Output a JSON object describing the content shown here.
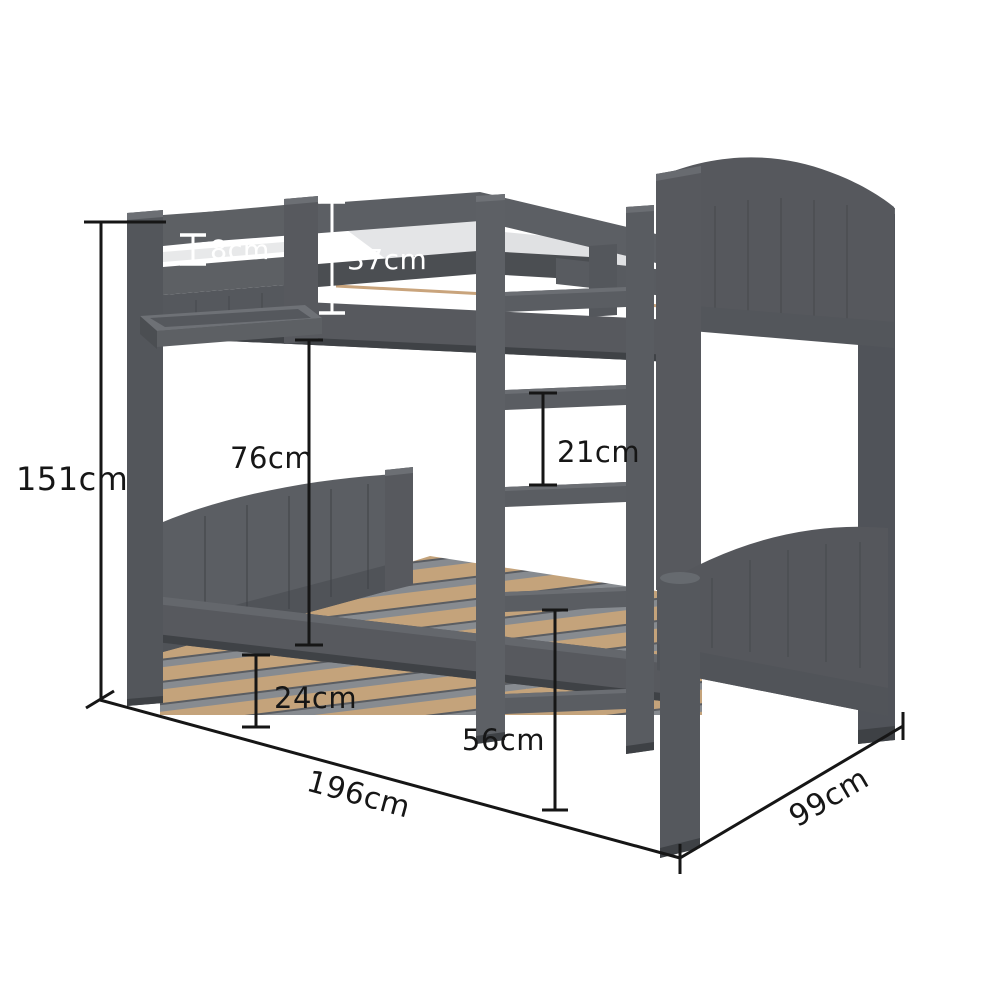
{
  "figure": {
    "type": "product-dimension-diagram",
    "subject": "grey wooden bunk bed with front ladder and slatted base",
    "background": "#ffffff"
  },
  "palette": {
    "bed_grey": "#57595e",
    "bed_grey_light": "#6c6f74",
    "bed_grey_dark": "#45474b",
    "slat_wood": "#c4a37b",
    "slat_gap": "#878b90",
    "annotation_black": "#161616",
    "annotation_white": "#ffffff"
  },
  "dims": {
    "overall_height": {
      "label": "151cm",
      "color": "black",
      "measures": "total bed height"
    },
    "guard_gap": {
      "label": "8cm",
      "color": "white",
      "measures": "gap between guard rails"
    },
    "guardrail_height": {
      "label": "37cm",
      "color": "white",
      "measures": "guard rail above upper base"
    },
    "bunk_gap": {
      "label": "76cm",
      "color": "black",
      "measures": "clearance between bunks"
    },
    "rung_spacing": {
      "label": "21cm",
      "color": "black",
      "measures": "ladder rung spacing"
    },
    "underbed_clearance": {
      "label": "24cm",
      "color": "black",
      "measures": "under-bed clearance"
    },
    "lower_deck_height": {
      "label": "56cm",
      "color": "black",
      "measures": "lower slat base height"
    },
    "length": {
      "label": "196cm",
      "color": "black",
      "measures": "bed length"
    },
    "width": {
      "label": "99cm",
      "color": "black",
      "measures": "bed width"
    }
  }
}
